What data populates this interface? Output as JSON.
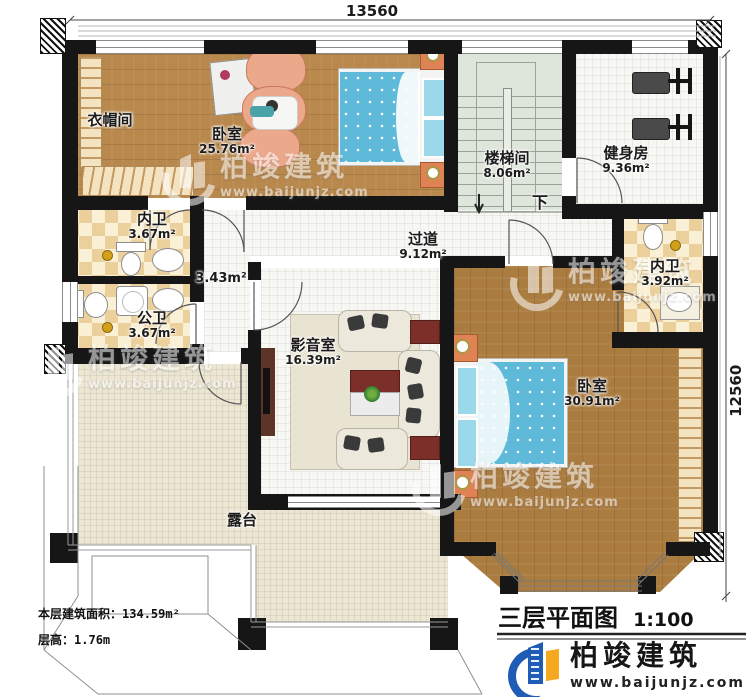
{
  "dimensions": {
    "top": "13560",
    "right": "12560"
  },
  "rooms": {
    "cloakroom": {
      "name": "衣帽间"
    },
    "bedroom1": {
      "name": "卧室",
      "area": "25.76m²"
    },
    "stairwell": {
      "name": "楼梯间",
      "area": "8.06m²"
    },
    "gym": {
      "name": "健身房",
      "area": "9.36m²"
    },
    "ensuite1": {
      "name": "内卫",
      "area": "3.67m²"
    },
    "publicbath": {
      "name": "公卫",
      "area": "3.67m²"
    },
    "corridor": {
      "name": "过道",
      "area": "9.12m²"
    },
    "nook": {
      "area": "3.43m²"
    },
    "media": {
      "name": "影音室",
      "area": "16.39m²"
    },
    "ensuite2": {
      "name": "内卫",
      "area": "3.92m²"
    },
    "bedroom2": {
      "name": "卧室",
      "area": "30.91m²"
    },
    "terrace": {
      "name": "露台"
    }
  },
  "stairs": {
    "down_label": "下"
  },
  "footer": {
    "area_label": "本层建筑面积：",
    "area_value": "134.59m²",
    "floor_height_label": "层高：",
    "floor_height_value": "1.76m",
    "plan_title": "三层平面图",
    "scale": "1:100"
  },
  "brand": {
    "name": "柏竣建筑",
    "website": "www.baijunjz.com"
  },
  "colors": {
    "wall": "#161616",
    "wood_light": "#b8884c",
    "wood_dark": "#ab7c40",
    "stair": "#dee5da",
    "tile": "#f7f7f3",
    "checker": "#ecd09b",
    "terrace": "#ece6d3",
    "bed_blue": "#5fb9d8",
    "pillow_blue": "#9ad8ea",
    "sofa_cream": "#ece8dc",
    "sofa_salmon": "#eba88b",
    "table_red": "#7b2f28",
    "nightstand_orange": "#df8355",
    "logo_blue": "#1f5cb5",
    "logo_orange": "#f6a820"
  }
}
